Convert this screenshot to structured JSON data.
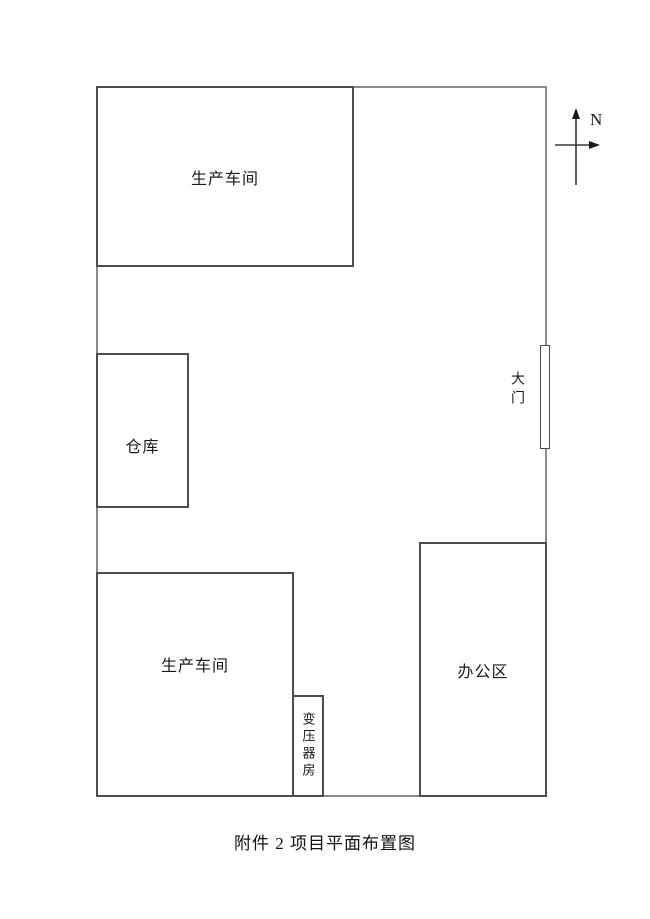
{
  "diagram": {
    "caption": "附件 2  项目平面布置图",
    "compass": {
      "label": "N"
    },
    "site": {
      "buildings": {
        "workshop_top": {
          "label": "生产车间"
        },
        "warehouse": {
          "label": "仓库"
        },
        "workshop_bottom": {
          "label": "生产车间"
        },
        "transformer_room": {
          "label": "变压器房"
        },
        "office": {
          "label": "办公区"
        },
        "gate": {
          "label": "大门"
        }
      }
    },
    "colors": {
      "boundary_line": "#8a8a8a",
      "building_border": "#4d4d4d",
      "text": "#1a1a1a",
      "background": "#ffffff"
    }
  }
}
